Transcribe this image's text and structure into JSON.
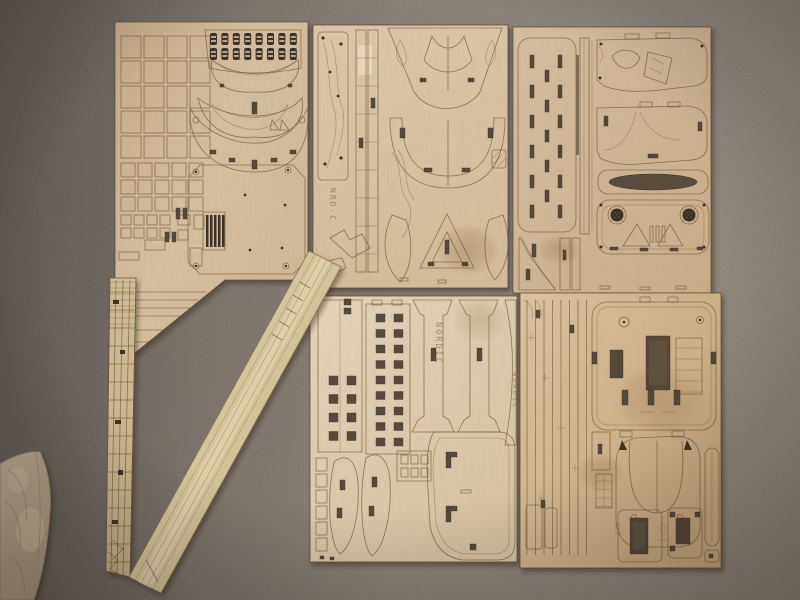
{
  "meta": {
    "type": "photograph",
    "subject": "Wooden model ship kit - laser-cut plywood part sheets laid out on a carpeted floor",
    "view": "top-down snapshot"
  },
  "labels": {
    "nordic": "NORDIC",
    "sheet_code": "NRD-C"
  },
  "palette": {
    "carpet_dark": "#6e665e",
    "carpet_light": "#968a7c",
    "plywood": "#dcc6a8",
    "plywood_light": "#ecdcc2",
    "burn_line": "#6f5434",
    "cutout": "#4c4032",
    "strip_wood": "#d6c49e",
    "lattice_wood": "#cdb795",
    "cloth": "#b1a187"
  },
  "objects": {
    "sheets": [
      {
        "id": "top-left",
        "desc": "Fret with window-frame grids, two rows of cut-out numerals, curved transom pieces and octagonal deck with engine-room grating"
      },
      {
        "id": "top-middle",
        "desc": "Fret with keel strips, bow and stern hull frames",
        "engraving": "NRD-C"
      },
      {
        "id": "top-right",
        "desc": "Fret with slotted main deck, superstructure sides, oval cut-out and winch plate with two round hawse holes"
      },
      {
        "id": "bottom-middle",
        "desc": "Fret with hull side walls pierced by rows of square windows and bulwarks engraved NORDIC"
      },
      {
        "id": "bottom-right",
        "desc": "Fret with deck panels, dark hatch openings, bow deck and cabin parts"
      }
    ],
    "loose_parts": [
      {
        "id": "lattice-strip",
        "desc": "Narrow fret of railing and ladder parts lying vertically at the left"
      },
      {
        "id": "stringer-bundle",
        "desc": "Bundle of long planking strips lying diagonally across the lower left"
      },
      {
        "id": "cloth",
        "desc": "Folded beige sail cloth at the lower-left edge"
      }
    ]
  }
}
